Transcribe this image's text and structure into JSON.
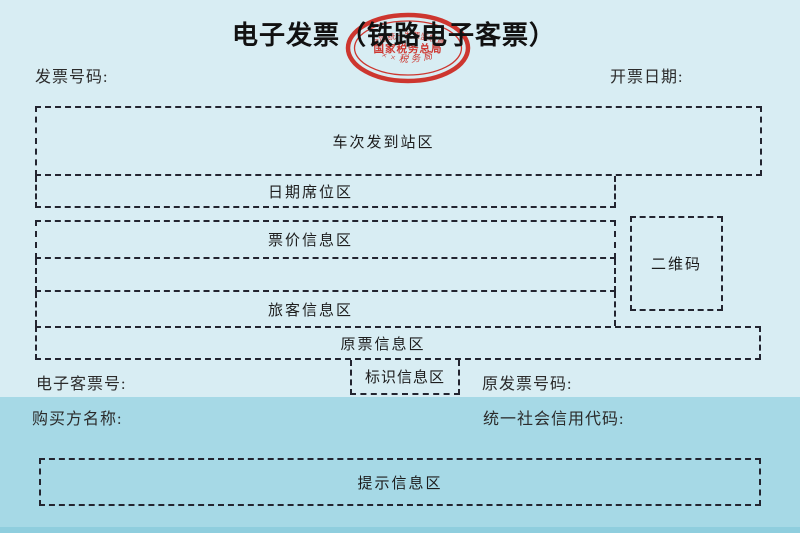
{
  "header": {
    "title": "电子发票（铁路电子客票）",
    "invoice_number_label": "发票号码:",
    "issue_date_label": "开票日期:"
  },
  "stamp": {
    "top_arc_text": "全国统一发票监制章",
    "center_text": "国家税务总局",
    "bottom_arc_text": "××税务局",
    "color": "#cd271f"
  },
  "zones": {
    "train_station_area": "车次发到站区",
    "date_seat_area": "日期席位区",
    "fare_info_area": "票价信息区",
    "passenger_info_area": "旅客信息区",
    "original_ticket_info_area": "原票信息区",
    "qr_code_area": "二维码",
    "identification_info_area": "标识信息区",
    "notice_info_area": "提示信息区"
  },
  "fields": {
    "eticket_number_label": "电子客票号:",
    "original_invoice_number_label": "原发票号码:",
    "buyer_name_label": "购买方名称:",
    "credit_code_label": "统一社会信用代码:"
  },
  "colors": {
    "page_background": "#d8edf3",
    "lower_band": "#a6d9e6",
    "bottom_strip": "#8fcede",
    "dashed_border": "#232530",
    "stamp_red": "#cd271f"
  }
}
